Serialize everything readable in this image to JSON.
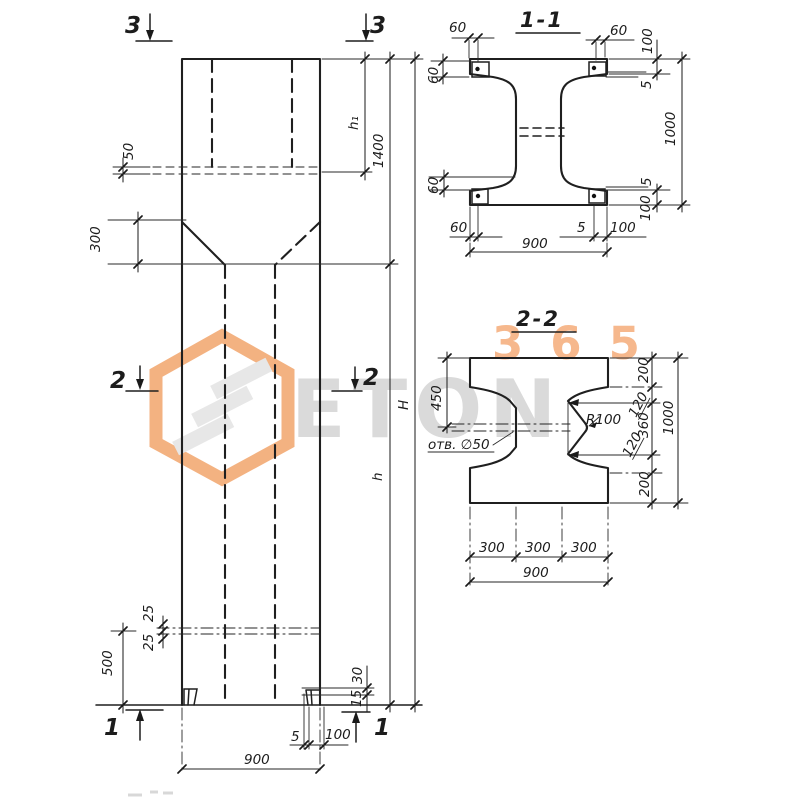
{
  "watermark": {
    "brand": "ETON",
    "number": "365"
  },
  "elevation": {
    "marker_top_left": "3",
    "marker_top_right": "3",
    "marker_mid_left": "2",
    "marker_mid_right": "2",
    "marker_bottom_left": "1",
    "marker_bottom_right": "1",
    "dim_50": "50",
    "dim_300": "300",
    "dim_h1": "h₁",
    "dim_1400": "1400",
    "dim_h": "h",
    "dim_H": "H",
    "dim_25_upper": "25",
    "dim_25_lower": "25",
    "dim_500": "500",
    "dim_30": "30",
    "dim_15": "15",
    "dim_5": "5",
    "dim_100": "100",
    "dim_900": "900"
  },
  "section_1_1": {
    "title": "1-1",
    "dim_60_top_left": "60",
    "dim_60_top_right": "60",
    "dim_100_top": "100",
    "dim_5_top": "5",
    "dim_1000": "1000",
    "dim_5_bottom": "5",
    "dim_100_bottom": "100",
    "dim_60_left_top": "60",
    "dim_60_left_bottom": "60",
    "dim_60_bottom": "60",
    "dim_5_bottom_bar": "5",
    "dim_100_bottom_edge": "100",
    "dim_900": "900"
  },
  "section_2_2": {
    "title": "2-2",
    "dim_450": "450",
    "hole_label": "отв. ∅50",
    "radius_label": "R100",
    "dim_200_top": "200",
    "dim_120_top": "120",
    "dim_360": "360",
    "dim_120_bottom": "120",
    "dim_200_bottom": "200",
    "dim_1000": "1000",
    "dim_300_a": "300",
    "dim_300_b": "300",
    "dim_300_c": "300",
    "dim_900": "900"
  }
}
